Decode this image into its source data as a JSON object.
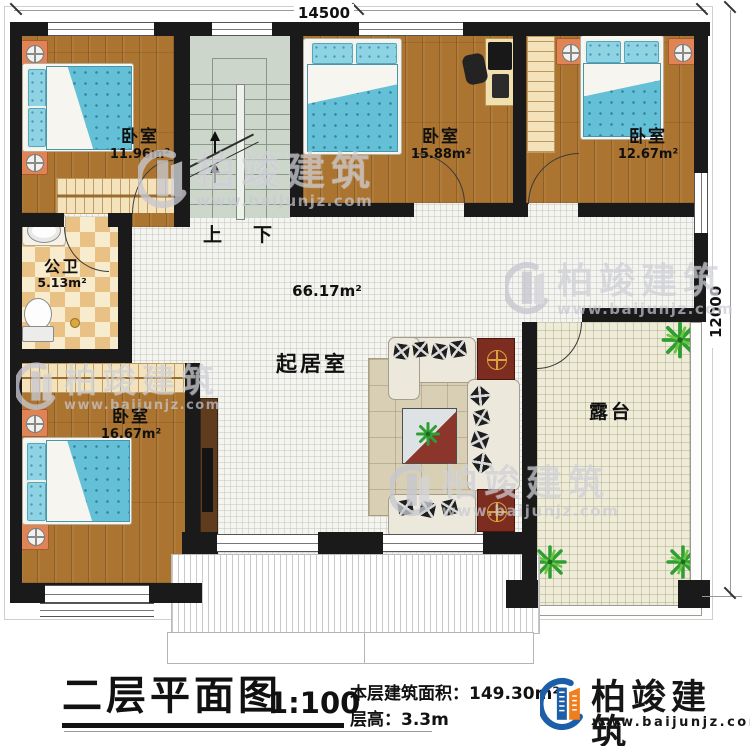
{
  "plan": {
    "dim_top": "14500",
    "dim_right": "12000",
    "stairs": {
      "up": "上",
      "down": "下"
    },
    "rooms": [
      {
        "name": "卧室",
        "area": "11.96m²"
      },
      {
        "name": "卧室",
        "area": "15.88m²"
      },
      {
        "name": "卧室",
        "area": "12.67m²"
      },
      {
        "name": "公卫",
        "area": "5.13m²"
      },
      {
        "name": "卧室",
        "area": "16.67m²"
      },
      {
        "name": "起居室",
        "area": "66.17m²"
      },
      {
        "name": "露台",
        "area": ""
      }
    ]
  },
  "watermark": {
    "brand": "柏竣建筑",
    "url": "www.baijunjz.com"
  },
  "title_block": {
    "title": "二层平面图",
    "scale": "1:100",
    "area_label": "本层建筑面积：",
    "area_value": "149.30m²",
    "floor_height_label": "层高：",
    "floor_height_value": "3.3m"
  },
  "logo": {
    "brand": "柏竣建筑",
    "url": "www.baijunjz.com"
  },
  "colors": {
    "wall": "#1a1a1a",
    "wood": "#ab7430",
    "logo_blue": "#1c5fa8",
    "logo_orange": "#f07e1c"
  }
}
